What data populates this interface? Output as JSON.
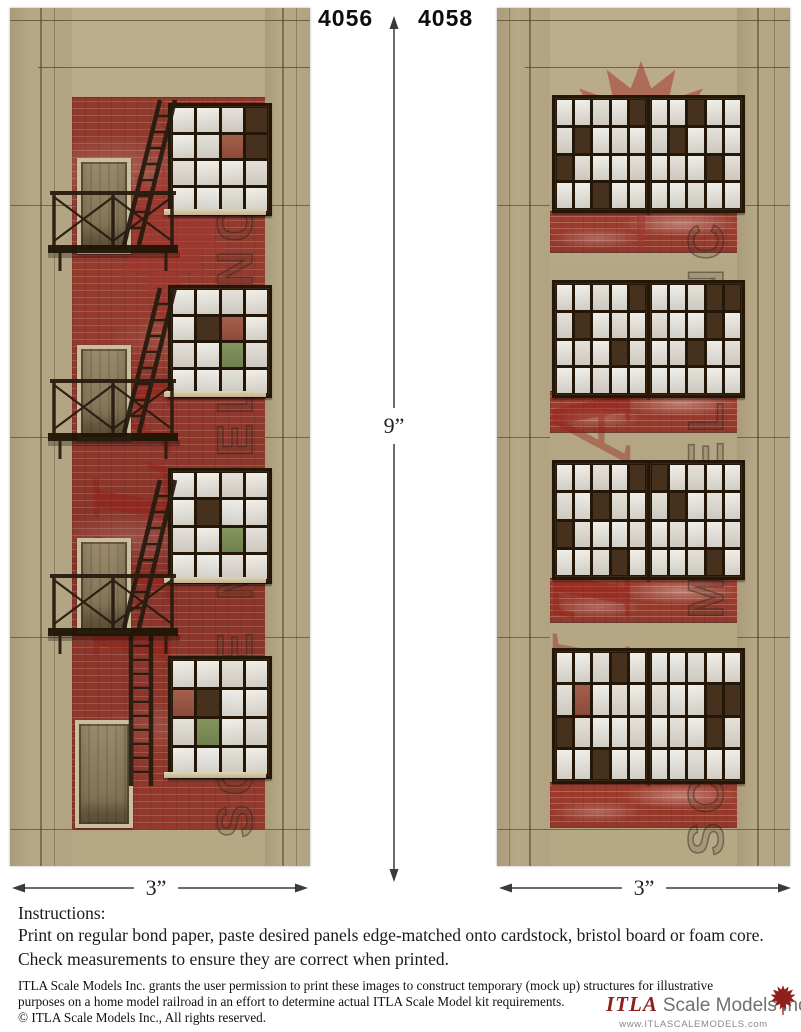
{
  "header": {
    "label_left": "4056",
    "label_right": "4058"
  },
  "dimensions": {
    "height": "9”",
    "width_left": "3”",
    "width_right": "3”"
  },
  "instructions": {
    "title": "Instructions:",
    "line1": "Print on regular bond paper, paste desired panels edge-matched onto cardstock, bristol board or foam core.",
    "line2": "Check measurements to ensure they are correct when printed."
  },
  "fine_print": {
    "line1": "ITLA Scale Models Inc. grants the user permission to print these images to construct temporary (mock up) structures for illustrative",
    "line2": "purposes on a home model railroad in an effort to determine actual ITLA Scale Model kit requirements.",
    "line3": "© ITLA Scale Models Inc., All rights reserved."
  },
  "logo": {
    "brand": "ITLA",
    "suffix": "Scale Models Inc.",
    "website": "www.ITLASCALEMODELS.com"
  },
  "watermarks": {
    "brand": "ITLA",
    "scale_text": "SCALE MODELS INC."
  },
  "colors": {
    "tan": "#b5a887",
    "brick": "#8e382d",
    "window_frame": "#241708",
    "pane": "#eae7e1",
    "pane_dark": "#46301e",
    "pane_green": "#7e8f5e",
    "fire_escape": "#281c10",
    "watermark_red": "#9b1e19",
    "logo_red": "#8e1f1c",
    "arrow": "#3a3a3a"
  },
  "panels": {
    "left": {
      "windows": [
        {
          "rows": 4,
          "cols": 4,
          "dark": [
            [
              0,
              3
            ],
            [
              1,
              3
            ]
          ],
          "red": [
            [
              1,
              2
            ]
          ],
          "green": []
        },
        {
          "rows": 4,
          "cols": 4,
          "dark": [
            [
              1,
              1
            ]
          ],
          "red": [
            [
              1,
              2
            ]
          ],
          "green": [
            [
              2,
              2
            ]
          ]
        },
        {
          "rows": 4,
          "cols": 4,
          "dark": [
            [
              1,
              1
            ]
          ],
          "red": [],
          "green": [
            [
              2,
              2
            ]
          ]
        },
        {
          "rows": 4,
          "cols": 4,
          "dark": [
            [
              1,
              1
            ]
          ],
          "red": [
            [
              1,
              0
            ]
          ],
          "green": [
            [
              2,
              1
            ]
          ]
        }
      ]
    },
    "right": {
      "windows": [
        {
          "rows": 4,
          "cols": 5,
          "dark": [
            [
              0,
              4
            ],
            [
              1,
              1
            ],
            [
              2,
              0
            ],
            [
              3,
              2
            ]
          ],
          "red": [],
          "green": []
        },
        {
          "rows": 4,
          "cols": 5,
          "dark": [
            [
              0,
              2
            ],
            [
              1,
              1
            ],
            [
              2,
              3
            ]
          ],
          "red": [],
          "green": []
        },
        {
          "rows": 4,
          "cols": 5,
          "dark": [
            [
              0,
              4
            ],
            [
              1,
              1
            ],
            [
              2,
              3
            ]
          ],
          "red": [],
          "green": []
        },
        {
          "rows": 4,
          "cols": 5,
          "dark": [
            [
              0,
              3
            ],
            [
              0,
              4
            ],
            [
              1,
              3
            ],
            [
              2,
              2
            ]
          ],
          "red": [],
          "green": []
        },
        {
          "rows": 4,
          "cols": 5,
          "dark": [
            [
              0,
              4
            ],
            [
              1,
              2
            ],
            [
              2,
              0
            ],
            [
              3,
              3
            ]
          ],
          "red": [],
          "green": []
        },
        {
          "rows": 4,
          "cols": 5,
          "dark": [
            [
              0,
              0
            ],
            [
              1,
              1
            ],
            [
              3,
              3
            ]
          ],
          "red": [],
          "green": []
        },
        {
          "rows": 4,
          "cols": 5,
          "dark": [
            [
              0,
              3
            ],
            [
              2,
              0
            ],
            [
              3,
              2
            ]
          ],
          "red": [
            [
              1,
              1
            ]
          ],
          "green": []
        },
        {
          "rows": 4,
          "cols": 5,
          "dark": [
            [
              1,
              3
            ],
            [
              1,
              4
            ],
            [
              2,
              3
            ]
          ],
          "red": [],
          "green": []
        }
      ]
    }
  }
}
